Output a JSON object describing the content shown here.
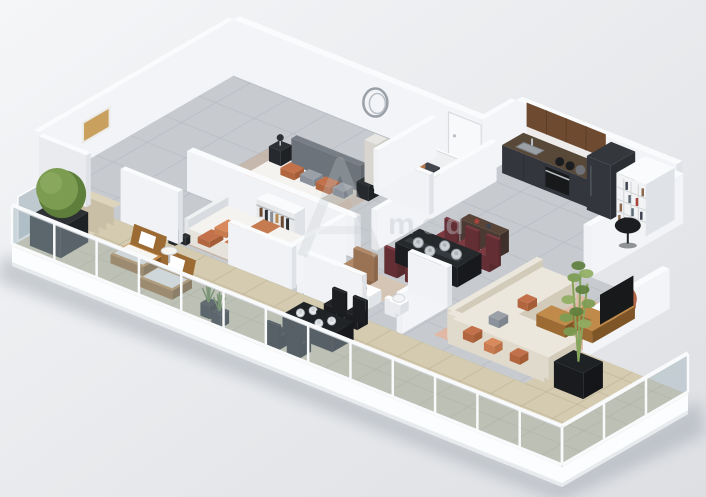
{
  "meta": {
    "title": "3D isometric apartment floor plan render",
    "width": 706,
    "height": 497,
    "style": "axonometric marketing render, furniture staged, facade walls removed"
  },
  "watermark": {
    "text": "med"
  },
  "colors": {
    "bg1": "#f5f6f8",
    "bg2": "#e6e8eb",
    "bg3": "#dddfe3",
    "shadow": "#99a0a8",
    "fascia": "#fcfdfe",
    "terrace": "#d5cbb0",
    "terrace_line": "#c2b89d",
    "concrete": "#c7cbd0",
    "concrete_line": "#b8bcc2",
    "wall_top": "#fafbfc",
    "wall_front": "#f1f2f5",
    "wall_side": "#dfe2e7",
    "back_wall": "#f3f4f7",
    "wall_ext": "#e9ebee",
    "glass": "rgba(160,180,188,0.45)",
    "glass_screen": "rgba(148,168,176,0.55)",
    "rail": "#f9fafb",
    "rug_living": "#e3b6a1",
    "rug_bed": "#c7a284",
    "rug_office": "#d8c3ae",
    "sofa_top": "#ece7dc",
    "sofa_front": "#e0dacc",
    "sofa_side": "#d2cbba",
    "pillow_orange": "#c3714b",
    "pillow_orange2": "#d88a5c",
    "pillow_gray": "#9aa0a8",
    "pouf": "#b26549",
    "wood": "#c08a4a",
    "wood_dark": "#9c6b33",
    "wood_deep": "#7d5526",
    "kitchen_dark": "#3b3f45",
    "kitchen_front": "#33373d",
    "kitchen_side": "#2b2f34",
    "kitchen_wood": "#6e4b30",
    "kitchen_wood_seam": "#5a3d26",
    "counter": "#584838",
    "fridge": "#34383d",
    "oven": "#17191a",
    "burgundy": "#7d3b41",
    "burgundy_dark": "#642f34",
    "burgundy_side": "#572a2e",
    "black": "#212427",
    "black2": "#1b1d20",
    "black3": "#17191c",
    "black_soft": "#2e3134",
    "metal": "#ccd1d5",
    "silver": "#b9bfc5",
    "green": "#7c9c52",
    "green_dark": "#5e7f3c",
    "green_light": "#8fae62",
    "planter": "#26292c",
    "planter2": "#1f2225",
    "bed_base_f": "#d5d1c9",
    "bed_base_s": "#c6c2ba",
    "mattress": "#f4f3f0",
    "blanket": "#c67a4f",
    "headboard_t": "#787e86",
    "headboard_f": "#6d737b",
    "headboard_s": "#62686f",
    "tan_chair": "#b08968",
    "tan_chair_d": "#9a7354",
    "marble": "#e8e6e2",
    "marble_f": "#d8d5d0",
    "marble_s": "#cfccc6",
    "white": "#ffffff",
    "tub_inner": "#eef0f2",
    "door": "#f8f9fa",
    "door_edge": "#d8dbdf",
    "art": "#c9a05e",
    "mirror": "#99a0a7",
    "copper": "#b5764a",
    "copper2": "#c98a5e",
    "watermark": "#c2c8cd",
    "book1": "#8a6a4f",
    "book2": "#5f6a77",
    "book3": "#a8443c",
    "book4": "#3d4450",
    "clothes1": "#6b4a33",
    "clothes2": "#2e3235",
    "clothes3": "#8a8f96",
    "clothes4": "#b98a52",
    "cushion": "#f6f5f2"
  },
  "scene": {
    "rooms": [
      "terrace",
      "single-bedroom",
      "master-bedroom",
      "bathroom",
      "entry-hall",
      "office-nook",
      "wc",
      "dining-area",
      "kitchen",
      "living-room"
    ],
    "terrace_items": [
      "topiary-ball-planter",
      "privacy-glass-screen",
      "stairs",
      "wood-loungers",
      "side-table",
      "black-outdoor-dining-set",
      "grass-planters",
      "bamboo-planter",
      "glass-railing"
    ],
    "furniture": [
      "double-bed",
      "round-mirror",
      "nightstands",
      "single-bed",
      "desk",
      "wall-art",
      "wardrobe",
      "bathtub",
      "washing-machine",
      "entry-door",
      "toilet",
      "dining-table-burgundy-chairs",
      "kitchen-run",
      "fridge",
      "bookshelf",
      "dome-floor-lamp",
      "l-shaped-sofa",
      "coffee-tables",
      "terracotta-pouf",
      "tv-console"
    ]
  }
}
